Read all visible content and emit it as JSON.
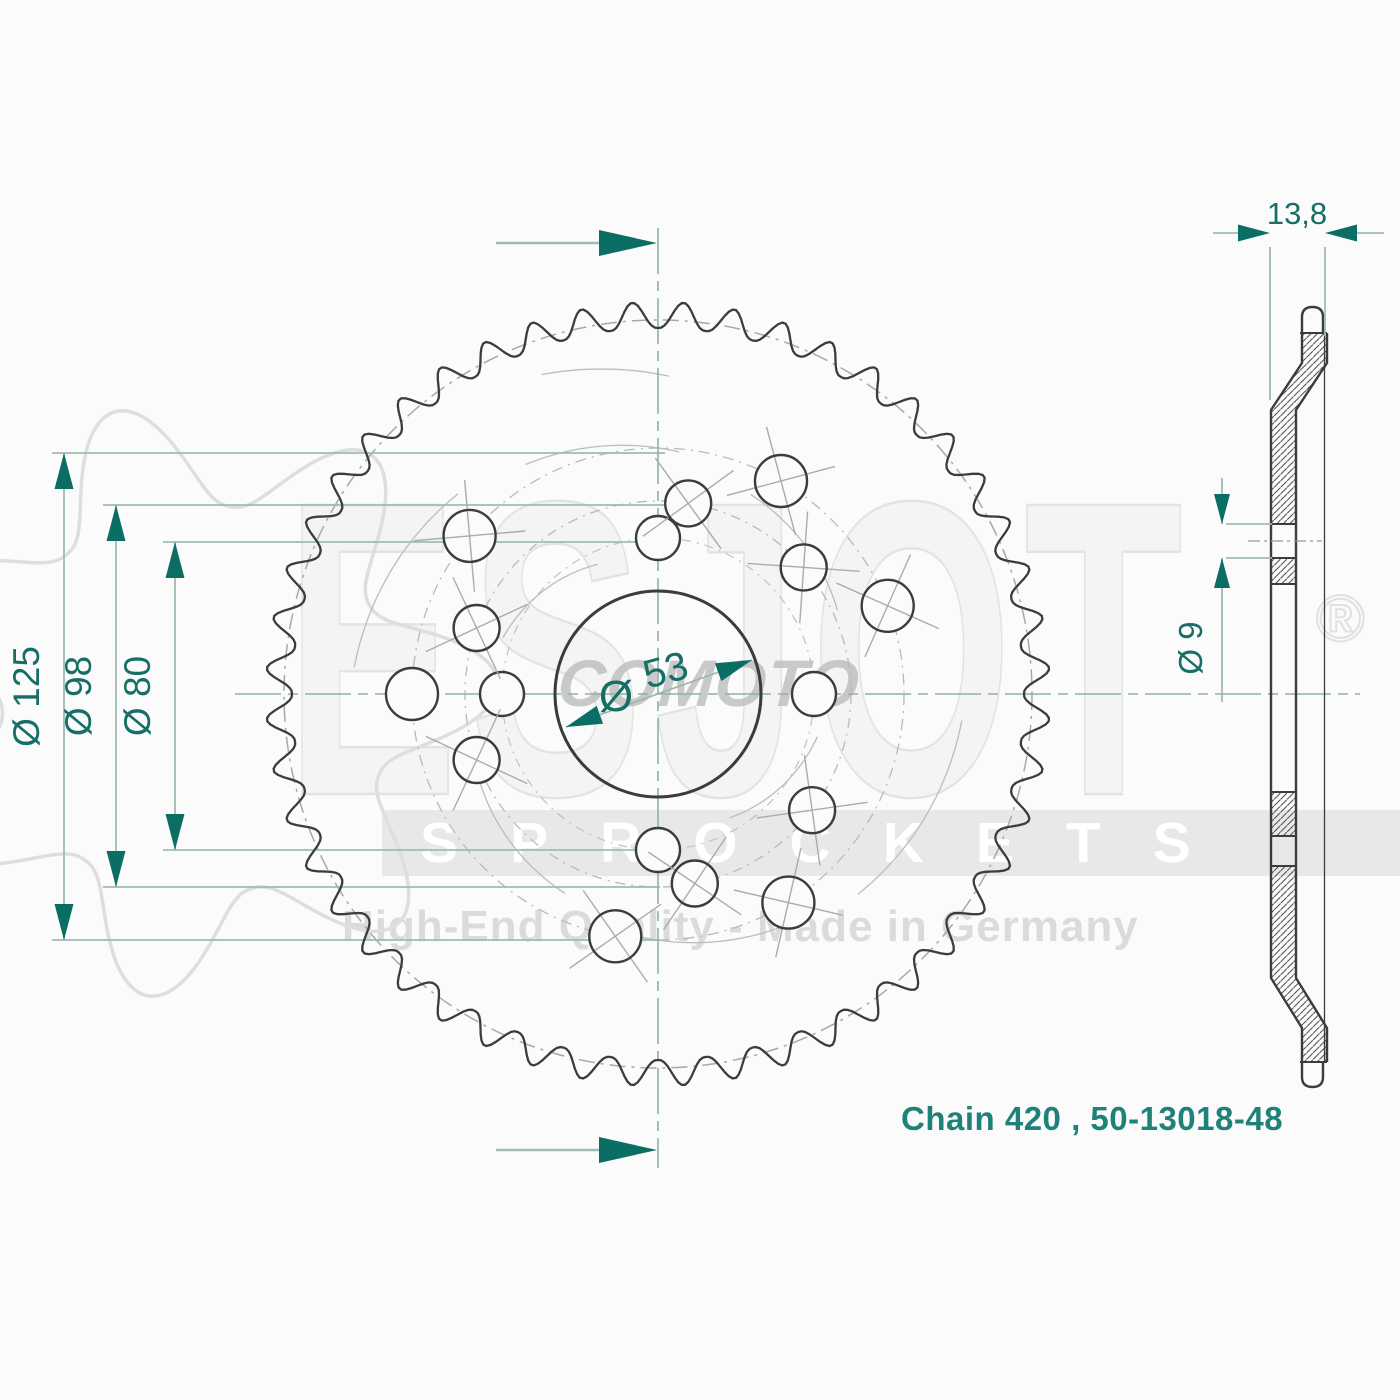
{
  "title": "sprocket-technical-drawing",
  "colors": {
    "background": "#fbfbfb",
    "line_dark": "#3c3c3c",
    "teal_text": "#156f66",
    "teal_arrow": "#0b6e64",
    "teal_line": "#9fbcb4",
    "centerline": "#8db1aa",
    "construction": "#b9b9b9",
    "tick": "#ababab",
    "hatch": "#4f4f4f",
    "part_code": "#1f8278",
    "watermark_gray": "#e3e3e3"
  },
  "part_code": "Chain 420 , 50-13018-48",
  "watermark": {
    "brand": "ESJOT",
    "reg": "®",
    "band_text": "SPROCKETS",
    "tagline": "High-End Quality - Made in Germany",
    "shop": "COMOTO"
  },
  "front_view": {
    "center": {
      "x": 658,
      "y": 694
    },
    "teeth": {
      "count": 48,
      "root_radius": 366,
      "tip_radius": 392
    },
    "bore_radius": 103,
    "construction_circles": [
      {
        "r": 156,
        "dash": "9 6 2 6",
        "color": "#c2c2c2",
        "w": 1.2
      },
      {
        "r": 193,
        "dash": "10 6 2 6",
        "color": "#b9b9b9",
        "w": 1.3
      },
      {
        "r": 246,
        "dash": "11 6 2 6",
        "color": "#b9b9b9",
        "w": 1.3
      },
      {
        "r": 374,
        "dash": "16 6 3 6",
        "color": "#a8a8a8",
        "w": 1.5
      }
    ],
    "hole_rings": [
      {
        "radius": 156,
        "hole_r": 22,
        "angles": [
          -90,
          0,
          90,
          180
        ],
        "cross": [
          false,
          false,
          false,
          false
        ]
      },
      {
        "radius": 193,
        "hole_r": 23,
        "angles": [
          -81,
          -41,
          37,
          79,
          160,
          -160
        ],
        "cross": [
          true,
          true,
          true,
          true,
          true,
          true
        ]
      },
      {
        "radius": 246,
        "hole_r": 26,
        "angles": [
          -140,
          -60,
          -21,
          58,
          100,
          180
        ],
        "cross": [
          true,
          true,
          true,
          true,
          true,
          false
        ]
      }
    ],
    "swirl_arcs": [
      {
        "r": 305,
        "a1": 185,
        "a2": 225
      },
      {
        "r": 305,
        "a1": 5,
        "a2": 45
      },
      {
        "r": 220,
        "a1": 115,
        "a2": 155
      },
      {
        "r": 220,
        "a1": -65,
        "a2": -25
      },
      {
        "r": 265,
        "a1": 240,
        "a2": 275
      },
      {
        "r": 165,
        "a1": 200,
        "a2": 245
      },
      {
        "r": 165,
        "a1": 15,
        "a2": 60
      },
      {
        "r": 340,
        "a1": 250,
        "a2": 272
      },
      {
        "r": 265,
        "a1": 60,
        "a2": 95
      }
    ],
    "centerlines": {
      "vertical": {
        "x": 658,
        "y1": 228,
        "y2": 1168
      },
      "horizontal": {
        "y": 694,
        "x1": 235,
        "x2": 1360
      }
    },
    "extension_lines": [
      {
        "y": 453,
        "x1": 52,
        "x2": 665
      },
      {
        "y": 505,
        "x1": 103,
        "x2": 692
      },
      {
        "y": 542,
        "x1": 163,
        "x2": 660
      },
      {
        "y": 850,
        "x1": 163,
        "x2": 660
      },
      {
        "y": 887,
        "x1": 103,
        "x2": 660
      },
      {
        "y": 940,
        "x1": 52,
        "x2": 660
      }
    ],
    "dims": [
      {
        "label": "Ø 125",
        "x": 64,
        "y1": 453,
        "y2": 940,
        "label_x": 39
      },
      {
        "label": "Ø 98",
        "x": 116,
        "y1": 505,
        "y2": 887,
        "label_x": 91
      },
      {
        "label": "Ø 80",
        "x": 175,
        "y1": 542,
        "y2": 850,
        "label_x": 150
      }
    ],
    "bore_dim": {
      "symbol": "Ø",
      "value": "53",
      "symbol_pos": {
        "x": 616,
        "y": 711
      },
      "value_pos": {
        "x": 669,
        "y": 683,
        "rot": -15
      },
      "line": {
        "x1": 566,
        "y1": 727,
        "x2": 752,
        "y2": 660
      }
    },
    "view_arrows": [
      {
        "y": 243
      },
      {
        "y": 1150
      }
    ],
    "view_arrow_geom": {
      "line_x1": 496,
      "line_x2": 602,
      "tip_x": 657
    }
  },
  "side_view": {
    "web_left": 1271,
    "web_right": 1296,
    "rim_left": 1302,
    "rim_right": 1327,
    "cap_left": 1302,
    "cap_right": 1323,
    "silhouette_x": 1324.5,
    "top": {
      "cap_tip": 307,
      "cap_base": 333,
      "rim_end": 363,
      "slant_end": 410
    },
    "bottom": {
      "cap_tip": 1087,
      "cap_base": 1062,
      "rim_end": 1028,
      "slant_end": 978
    },
    "web_hatch_bands": [
      [
        410,
        524
      ],
      [
        558,
        584
      ],
      [
        792,
        836
      ],
      [
        866,
        978
      ]
    ],
    "gap_lines": [
      524,
      558,
      584,
      792,
      836,
      866
    ],
    "hole_centerline": {
      "y": 541,
      "x1": 1248,
      "x2": 1322
    },
    "width_dim": {
      "label": "13,8",
      "line_y": 233,
      "text_x": 1297,
      "text_y": 224,
      "ext": [
        {
          "x": 1270,
          "y1": 247,
          "y2": 400
        },
        {
          "x": 1325,
          "y1": 247,
          "y2": 336
        }
      ],
      "tails": [
        {
          "x1": 1213,
          "x2": 1246
        },
        {
          "x1": 1350,
          "x2": 1384
        }
      ],
      "tips": [
        {
          "x": 1270,
          "dir": 0
        },
        {
          "x": 1325,
          "dir": 180
        }
      ]
    },
    "hole_dim": {
      "label": "Ø 9",
      "line_x": 1222,
      "text_x": 1202,
      "text_y": 648,
      "segs": [
        {
          "y1": 478,
          "y2": 524
        },
        {
          "y1": 558,
          "y2": 702
        }
      ],
      "tips": [
        {
          "y": 524,
          "dir": 90
        },
        {
          "y": 558,
          "dir": -90
        }
      ],
      "ext": [
        {
          "y": 524,
          "x1": 1226,
          "x2": 1272
        },
        {
          "y": 558,
          "x1": 1226,
          "x2": 1272
        }
      ]
    }
  },
  "logo_star": {
    "cx": 198,
    "cy": 700,
    "root": 196,
    "tip": 300,
    "teeth": 7
  }
}
